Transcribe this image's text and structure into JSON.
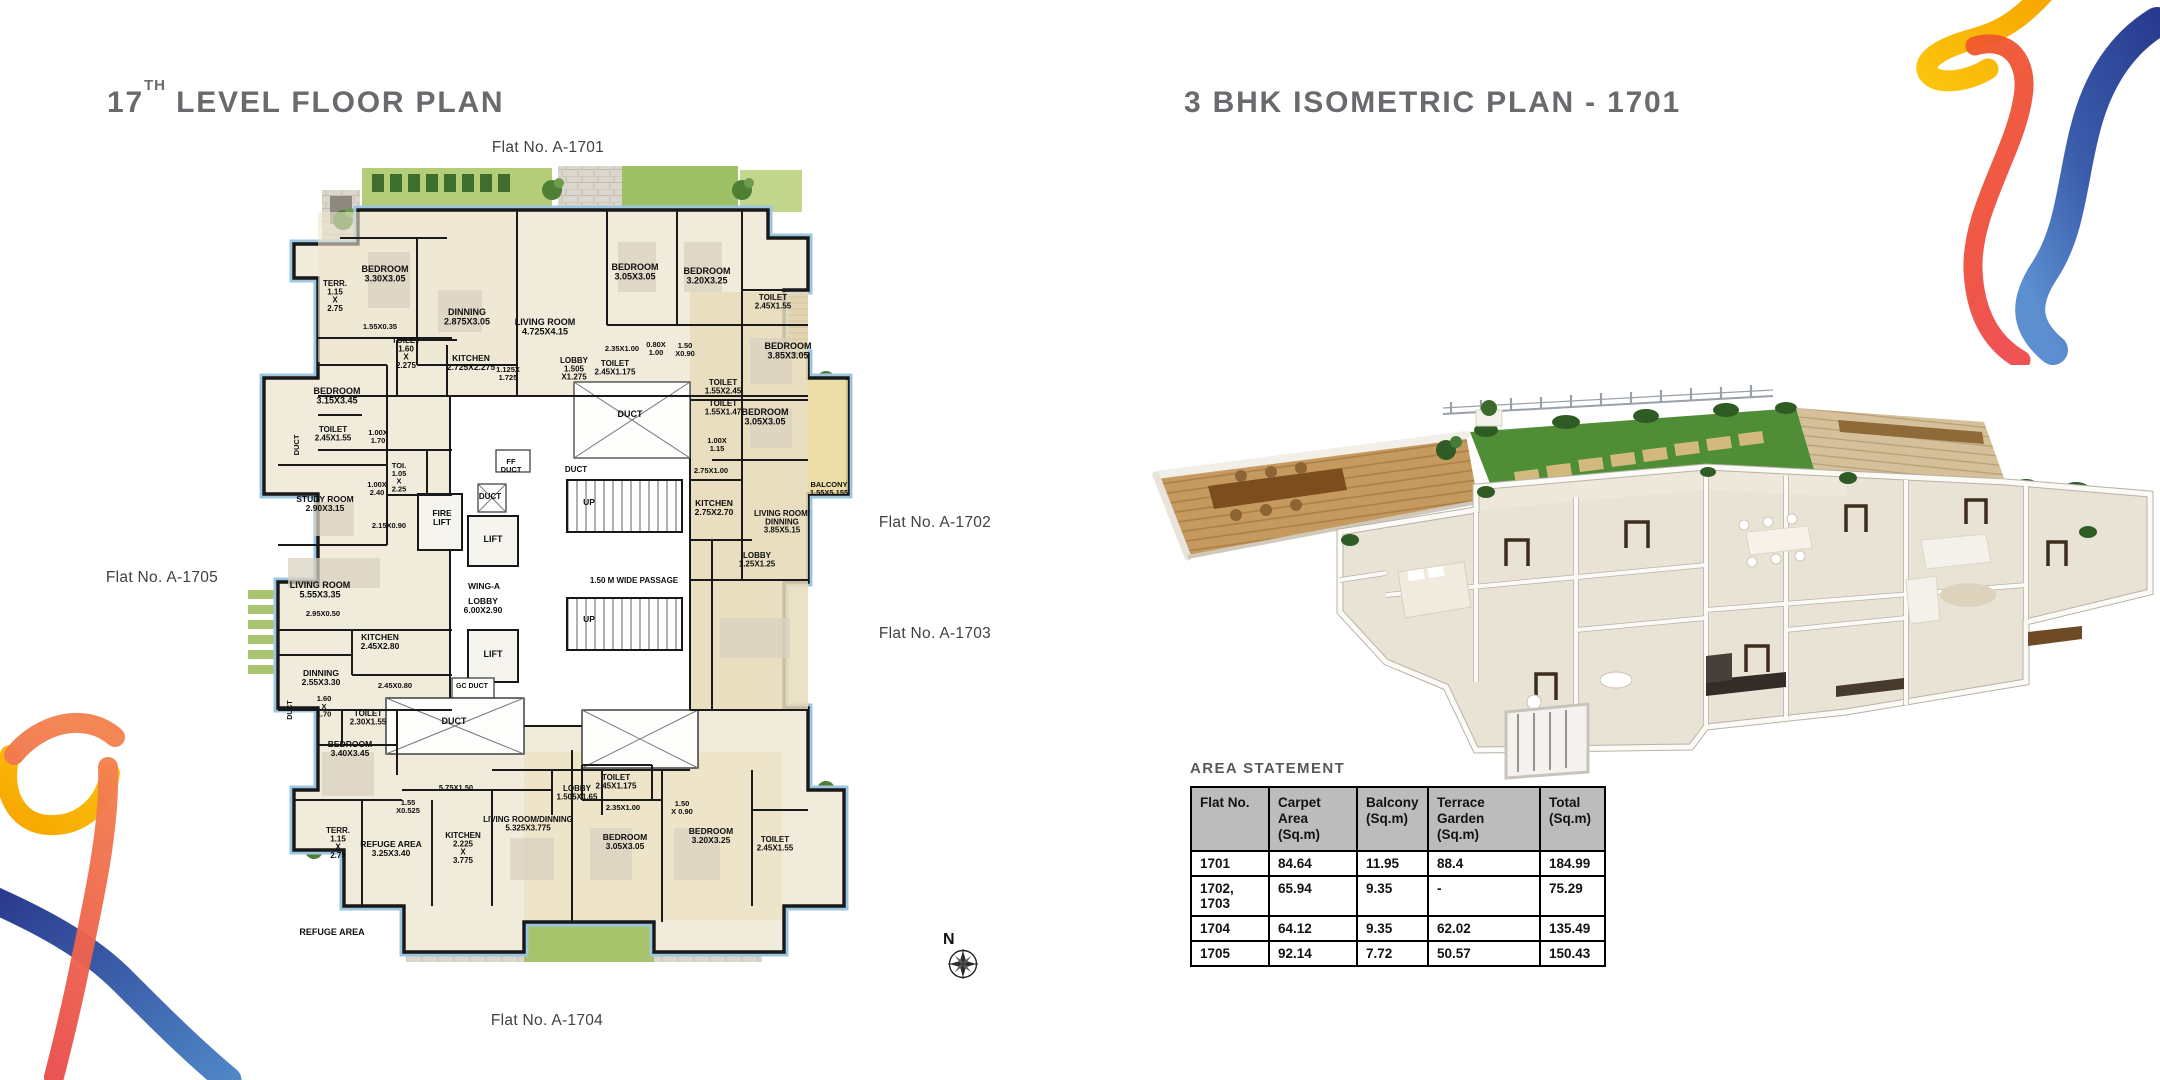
{
  "titles": {
    "left_num": "17",
    "left_sup": "TH",
    "left_rest": " LEVEL FLOOR PLAN",
    "right": "3 BHK ISOMETRIC PLAN - 1701"
  },
  "colors": {
    "title_gray": "#696a6d",
    "table_header_bg": "#bcbcbd",
    "plan_outline_blue": "#9cc6e0",
    "ribbon_blue": "#2b3990",
    "ribbon_light_blue": "#4e86c6",
    "ribbon_red": "#ee4c4c",
    "ribbon_orange": "#f7a600",
    "ribbon_yellow": "#fbc40d",
    "lawn_green": "#4f8d36",
    "plan_cream": "#f1ebdb"
  },
  "floor_plan": {
    "compass_label": "N",
    "flat_tags": [
      {
        "label": "Flat No. A-1701",
        "x": 548,
        "y": 148
      },
      {
        "label": "Flat No. A-1702",
        "x": 935,
        "y": 523
      },
      {
        "label": "Flat No. A-1703",
        "x": 935,
        "y": 634
      },
      {
        "label": "Flat No. A-1704",
        "x": 547,
        "y": 1021
      },
      {
        "label": "Flat No. A-1705",
        "x": 162,
        "y": 578
      }
    ],
    "room_labels": [
      {
        "t": "BEDROOM\n3.30X3.05",
        "x": 163,
        "y": 122
      },
      {
        "t": "TERR.\n1.15\nX\n2.75",
        "x": 113,
        "y": 136,
        "s": 8
      },
      {
        "t": "1.55X0.35",
        "x": 158,
        "y": 179,
        "s": 7.5
      },
      {
        "t": "DINNING\n2.875X3.05",
        "x": 245,
        "y": 165
      },
      {
        "t": "LIVING ROOM\n4.725X4.15",
        "x": 323,
        "y": 175
      },
      {
        "t": "TOILET\n1.60\nX\n2.275",
        "x": 184,
        "y": 193,
        "s": 8
      },
      {
        "t": "KITCHEN\n2.725X2.275",
        "x": 249,
        "y": 211,
        "s": 8.5
      },
      {
        "t": "1.125X\n1.725",
        "x": 286,
        "y": 222,
        "s": 7.5
      },
      {
        "t": "BEDROOM\n3.05X3.05",
        "x": 413,
        "y": 120
      },
      {
        "t": "BEDROOM\n3.20X3.25",
        "x": 485,
        "y": 124
      },
      {
        "t": "TOILET\n2.45X1.55",
        "x": 551,
        "y": 150,
        "s": 8
      },
      {
        "t": "2.35X1.00",
        "x": 400,
        "y": 201,
        "s": 7.5
      },
      {
        "t": "0.80X\n1.00",
        "x": 434,
        "y": 197,
        "s": 7.5
      },
      {
        "t": "1.50\nX0.90",
        "x": 463,
        "y": 198,
        "s": 7.5
      },
      {
        "t": "LOBBY\n1.505\nX1.275",
        "x": 352,
        "y": 213,
        "s": 8
      },
      {
        "t": "TOILET\n2.45X1.175",
        "x": 393,
        "y": 216,
        "s": 8
      },
      {
        "t": "TOILET\n1.55X2.45",
        "x": 501,
        "y": 235,
        "s": 8
      },
      {
        "t": "TOILET\n1.55X1.47",
        "x": 501,
        "y": 256,
        "s": 8
      },
      {
        "t": "1.00X\n1.15",
        "x": 495,
        "y": 293,
        "s": 7.5
      },
      {
        "t": "BEDROOM\n3.85X3.05",
        "x": 566,
        "y": 199
      },
      {
        "t": "BALCONY\n1.55X5.155",
        "x": 607,
        "y": 337,
        "s": 7.5
      },
      {
        "t": "BEDROOM\n3.05X3.05",
        "x": 543,
        "y": 265
      },
      {
        "t": "2.75X1.00",
        "x": 489,
        "y": 323,
        "s": 7.5
      },
      {
        "t": "KITCHEN\n2.75X2.70",
        "x": 492,
        "y": 356,
        "s": 8.5
      },
      {
        "t": "LIVING ROOM/\nDINNING\n3.85X5.15",
        "x": 560,
        "y": 366,
        "s": 8
      },
      {
        "t": "LOBBY\n1.25X1.25",
        "x": 535,
        "y": 408,
        "s": 8
      },
      {
        "t": "DUCT",
        "x": 408,
        "y": 267
      },
      {
        "t": "DUCT",
        "x": 354,
        "y": 322,
        "s": 8
      },
      {
        "t": "FF\nDUCT",
        "x": 289,
        "y": 314,
        "s": 7.5
      },
      {
        "t": "DUCT",
        "x": 268,
        "y": 349,
        "s": 8
      },
      {
        "t": "FIRE\nLIFT",
        "x": 220,
        "y": 366,
        "s": 8.5
      },
      {
        "t": "LIFT",
        "x": 271,
        "y": 392
      },
      {
        "t": "TOI.\n1.05\nX\n2.25",
        "x": 177,
        "y": 318,
        "s": 7.5
      },
      {
        "t": "UP",
        "x": 367,
        "y": 355,
        "s": 8.5
      },
      {
        "t": "WING-A",
        "x": 262,
        "y": 439,
        "s": 8.5
      },
      {
        "t": "LOBBY\n6.00X2.90",
        "x": 261,
        "y": 454,
        "s": 8.5
      },
      {
        "t": "1.50 M WIDE PASSAGE",
        "x": 412,
        "y": 433,
        "s": 8
      },
      {
        "t": "UP",
        "x": 367,
        "y": 472,
        "s": 8.5
      },
      {
        "t": "LIFT",
        "x": 271,
        "y": 507
      },
      {
        "t": "GC DUCT",
        "x": 250,
        "y": 538,
        "s": 7
      },
      {
        "t": "DUCT",
        "x": 232,
        "y": 574
      },
      {
        "t": "5.75X1.50",
        "x": 234,
        "y": 640,
        "s": 7.5
      },
      {
        "t": "BEDROOM\n3.15X3.45",
        "x": 115,
        "y": 244
      },
      {
        "t": "TOILET\n2.45X1.55",
        "x": 111,
        "y": 282,
        "s": 8
      },
      {
        "t": "1.00X\n1.70",
        "x": 156,
        "y": 285,
        "s": 7.5
      },
      {
        "t": "DUCT",
        "x": 77,
        "y": 295,
        "s": 7.5,
        "r": -90
      },
      {
        "t": "STUDY ROOM\n2.90X3.15",
        "x": 103,
        "y": 352,
        "s": 8.5
      },
      {
        "t": "1.00X\n2.40",
        "x": 155,
        "y": 337,
        "s": 7.5
      },
      {
        "t": "2.15X0.90",
        "x": 167,
        "y": 378,
        "s": 7.5
      },
      {
        "t": "LIVING ROOM\n5.55X3.35",
        "x": 98,
        "y": 438
      },
      {
        "t": "2.95X0.50",
        "x": 101,
        "y": 466,
        "s": 7.5
      },
      {
        "t": "KITCHEN\n2.45X2.80",
        "x": 158,
        "y": 490,
        "s": 8.5
      },
      {
        "t": "DINNING\n2.55X3.30",
        "x": 99,
        "y": 526,
        "s": 8.5
      },
      {
        "t": "2.45X0.80",
        "x": 173,
        "y": 538,
        "s": 7.5
      },
      {
        "t": "1.60\nX\n1.70",
        "x": 102,
        "y": 551,
        "s": 7.5
      },
      {
        "t": "TOILET\n2.30X1.55",
        "x": 146,
        "y": 566,
        "s": 8
      },
      {
        "t": "BEDROOM\n3.40X3.45",
        "x": 128,
        "y": 597,
        "s": 8.5
      },
      {
        "t": "DUCT",
        "x": 70,
        "y": 560,
        "s": 7,
        "r": -90
      },
      {
        "t": "1.55\nX0.525",
        "x": 186,
        "y": 655,
        "s": 7.5
      },
      {
        "t": "TERR.\n1.15\nX\n2.75",
        "x": 116,
        "y": 683,
        "s": 8
      },
      {
        "t": "REFUGE AREA\n3.25X3.40",
        "x": 169,
        "y": 697,
        "s": 8.5
      },
      {
        "t": "KITCHEN\n2.225\nX\n3.775",
        "x": 241,
        "y": 688,
        "s": 8
      },
      {
        "t": "LIVING ROOM/DINNING\n5.325X3.775",
        "x": 306,
        "y": 672,
        "s": 8
      },
      {
        "t": "LOBBY\n1.505X1.65",
        "x": 355,
        "y": 641,
        "s": 8
      },
      {
        "t": "TOILET\n2.45X1.175",
        "x": 394,
        "y": 630,
        "s": 8
      },
      {
        "t": "2.35X1.00",
        "x": 401,
        "y": 660,
        "s": 7.5
      },
      {
        "t": "1.50\nX 0.90",
        "x": 460,
        "y": 656,
        "s": 7.5
      },
      {
        "t": "BEDROOM\n3.05X3.05",
        "x": 403,
        "y": 690,
        "s": 8.5
      },
      {
        "t": "BEDROOM\n3.20X3.25",
        "x": 489,
        "y": 684,
        "s": 8.5
      },
      {
        "t": "TOILET\n2.45X1.55",
        "x": 553,
        "y": 692,
        "s": 8
      },
      {
        "t": "REFUGE AREA",
        "x": 110,
        "y": 785,
        "s": 9
      }
    ]
  },
  "area_statement": {
    "title": "AREA STATEMENT",
    "columns": [
      "Flat No.",
      "Carpet Area\n(Sq.m)",
      "Balcony\n(Sq.m)",
      "Terrace Garden\n(Sq.m)",
      "Total\n(Sq.m)"
    ],
    "rows": [
      [
        "1701",
        "84.64",
        "11.95",
        "88.4",
        "184.99"
      ],
      [
        "1702, 1703",
        "65.94",
        "9.35",
        "-",
        "75.29"
      ],
      [
        "1704",
        "64.12",
        "9.35",
        "62.02",
        "135.49"
      ],
      [
        "1705",
        "92.14",
        "7.72",
        "50.57",
        "150.43"
      ]
    ]
  }
}
